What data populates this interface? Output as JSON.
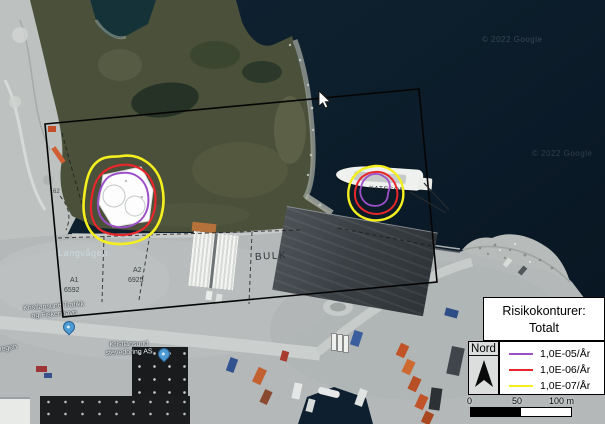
{
  "legend": {
    "title": [
      "Risikokonturer:",
      "Totalt"
    ],
    "north_label": "Nord",
    "entries": [
      {
        "label": "1,0E-05/År",
        "color": "#9c50c8"
      },
      {
        "label": "1,0E-06/År",
        "color": "#e8272c"
      },
      {
        "label": "1,0E-07/År",
        "color": "#f4ef1e"
      }
    ],
    "scale_ticks": [
      "0",
      "50",
      "100 m"
    ]
  },
  "map_labels": {
    "bay": "Langvågen",
    "parcel_a1": "A1",
    "parcel_a1_no": "6592",
    "parcel_a2": "A2",
    "parcel_a2_no": "6925",
    "parcel_b": "B",
    "parcel_b_no": "6532",
    "parcel_62": "62",
    "bulk": "BULK",
    "ship_name": "KATESON",
    "harbor": [
      "Kristiansund Trafikk",
      "og Fiskerihavn"
    ],
    "stevedoring": [
      "Kristiansund",
      "stevedoring AS"
    ],
    "road_partial": "vegen",
    "watermark": "© 2022 Google"
  },
  "colors": {
    "contour_1e5": "#9c50c8",
    "contour_1e6": "#e8272c",
    "contour_1e7": "#f4ef1e",
    "study_area_outline": "#050505",
    "water": "#0b1b2b"
  }
}
